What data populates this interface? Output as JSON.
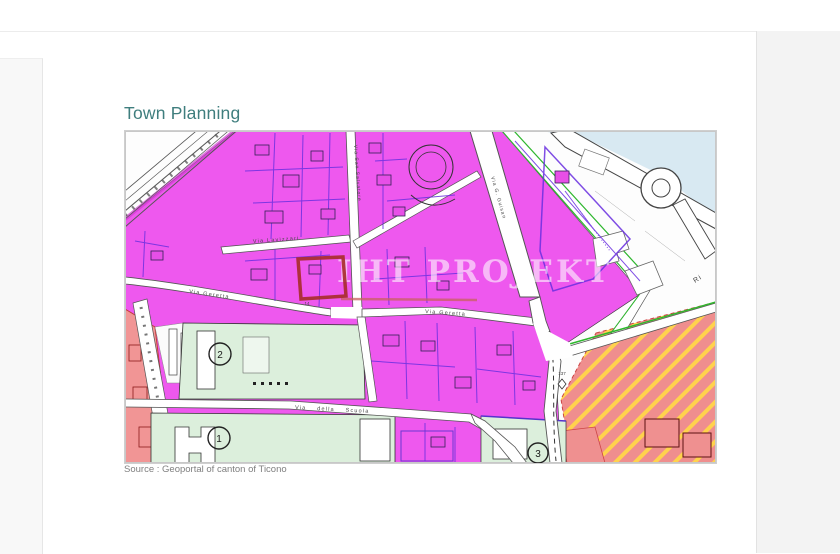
{
  "page": {
    "title": "Town Planning",
    "source": "Source : Geoportal of canton of Ticono"
  },
  "map": {
    "watermark": "IHT PROJEKT",
    "streets": {
      "lavizzari": "Via Lavizzari",
      "salvatore": "Via San Salvatore",
      "geretta_west": "Via Geretta",
      "geretta_east": "Via Geretta",
      "guisan": "Via G. Guisan",
      "scuola": "Via  della  Scuola",
      "riva": "Ri"
    },
    "zones": {
      "z1": "1",
      "z2": "2",
      "z3": "3"
    },
    "parcels": {
      "p137": "137",
      "p14": "14"
    },
    "colors": {
      "residential_magenta": "#ee58ee",
      "parcel_purple": "#6a2fe0",
      "public_green": "#dcefdc",
      "special_salmon": "#f09090",
      "hatch_yellow": "#ffd24d",
      "water_blue": "#d8e9f2",
      "highlight_red": "#a82c2c"
    }
  }
}
